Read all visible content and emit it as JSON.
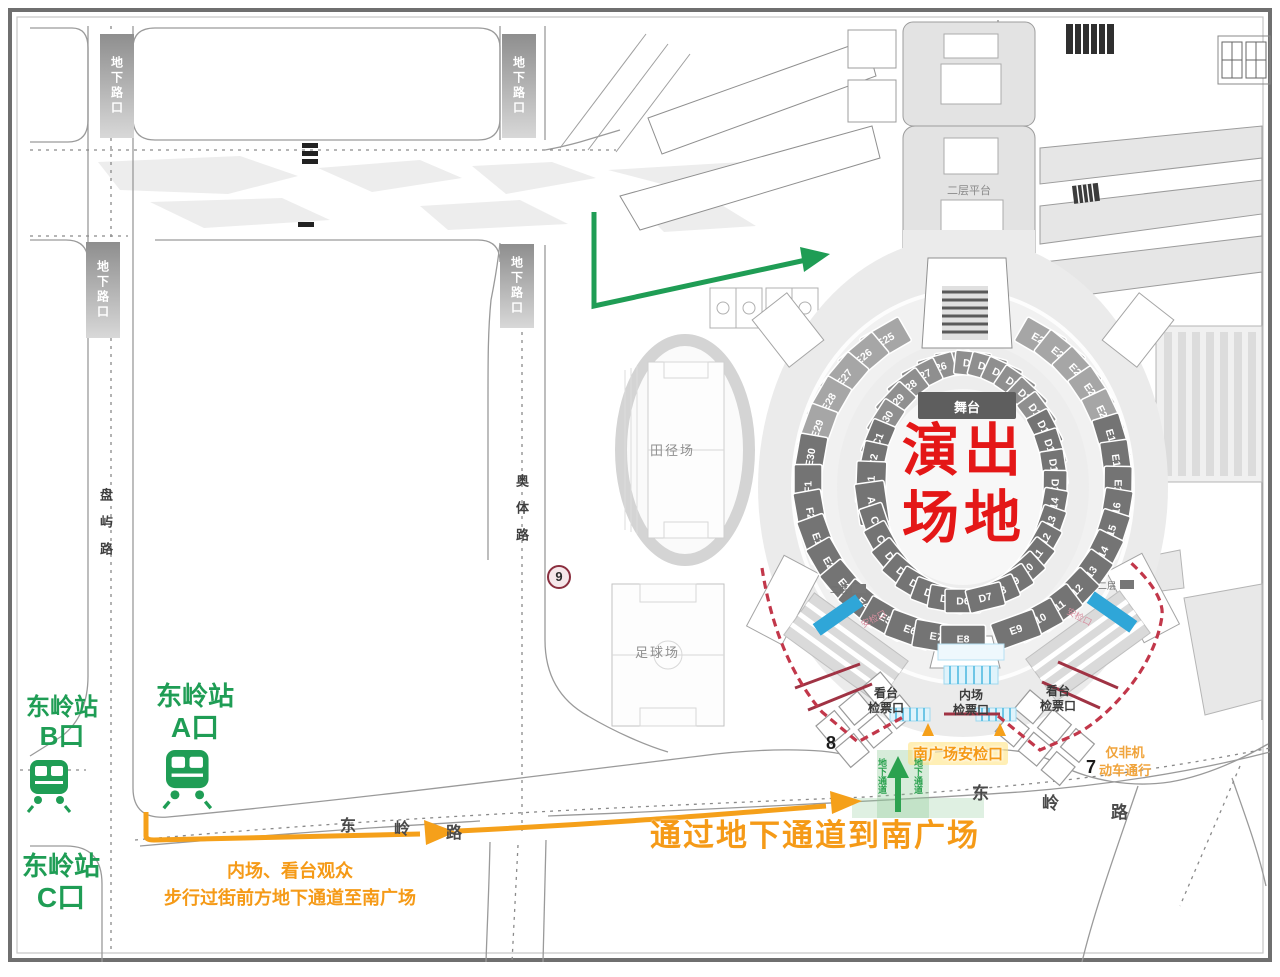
{
  "colors": {
    "accent_green": "#1f9d55",
    "accent_orange": "#f59a17",
    "title_red": "#e41717",
    "security_dash_red": "#c2374a",
    "barrier_red": "#a03344",
    "gate_cyan": "#49b7e0",
    "seat_dark": "#747474",
    "seat_mid": "#8f8f8f",
    "seat_light": "#a6a6a6",
    "stage_gray": "#5e5e5e"
  },
  "stadium": {
    "stage_label": "舞台",
    "field_title_line1": "演出",
    "field_title_line2": "场地",
    "rings": {
      "outer_left": [
        "E25",
        "E26",
        "E27",
        "E28",
        "E29",
        "E30",
        "F1",
        "F2",
        "E1",
        "E2",
        "E3",
        "E4",
        "E5",
        "E6",
        "E7",
        "E8"
      ],
      "outer_right": [
        "E24",
        "E23",
        "E22",
        "E21",
        "E20",
        "E19",
        "E18",
        "E17",
        "E16",
        "E15",
        "E14",
        "E13",
        "E12",
        "E11",
        "E10",
        "E9"
      ],
      "inner_left": [
        "D25",
        "D26",
        "D27",
        "D28",
        "D29",
        "D30",
        "C1",
        "C2",
        "A1",
        "A2",
        "C3",
        "C4",
        "D1",
        "D2",
        "D3",
        "D4",
        "D5",
        "D6"
      ],
      "inner_right": [
        "D24",
        "D23",
        "D22",
        "D21",
        "D20",
        "D19",
        "D18",
        "D17",
        "D16",
        "D15",
        "D14",
        "D13",
        "D12",
        "D11",
        "D10",
        "D9",
        "D8",
        "D7"
      ]
    },
    "light_sections": [
      "E20",
      "E21",
      "E22",
      "E23",
      "E24",
      "E25",
      "E26",
      "E27",
      "E28",
      "E29"
    ],
    "mid_sections": [
      "D19",
      "D20",
      "D21",
      "D22",
      "D23",
      "D24",
      "D25",
      "D26",
      "D27",
      "D28",
      "D29",
      "D30"
    ]
  },
  "venues": {
    "athletics_field": "田径场",
    "football_field": "足球场",
    "platform": "二层平台"
  },
  "roads": {
    "panyu": "盘屿路",
    "aoti": "奥体路",
    "dongling": "东岭路",
    "underpass_intersection": "地下路口"
  },
  "metro": {
    "station": "东岭站",
    "exit_a": "A口",
    "exit_b": "B口",
    "exit_c": "C口"
  },
  "gates": {
    "stand_line1": "看台",
    "stand_line2": "检票口",
    "infield_line1": "内场",
    "infield_line2": "检票口",
    "south_security": "南广场安检口",
    "side_security": "安检口",
    "level2": "二层"
  },
  "routes": {
    "main": "通过地下通道到南广场",
    "sub1": "内场、看台观众",
    "sub2": "步行过街前方地下通道至南广场",
    "underpass": "地下通道",
    "non_motor_line1": "仅非机",
    "non_motor_line2": "动车通行"
  },
  "markers": {
    "gate8": "8",
    "gate7": "7",
    "gate9": "9"
  }
}
